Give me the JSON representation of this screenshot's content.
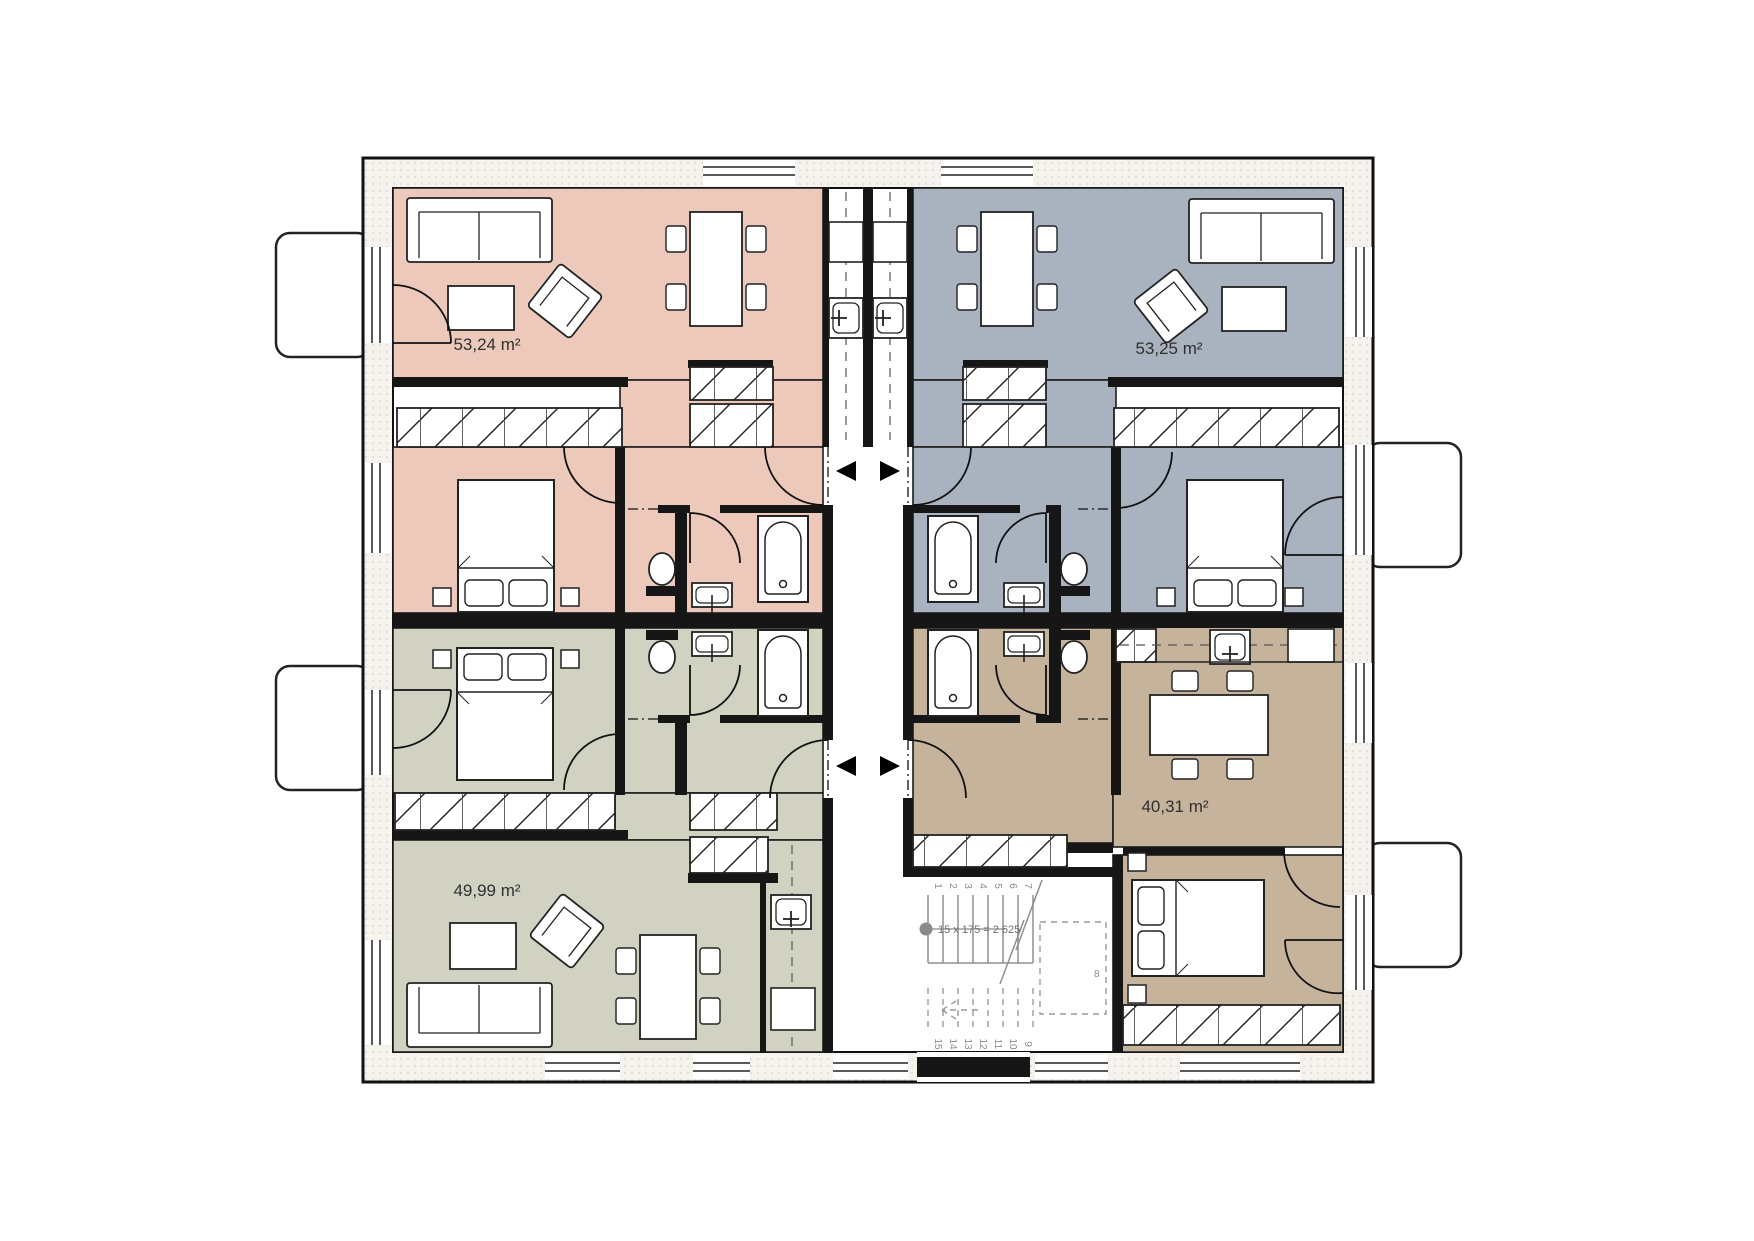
{
  "plan": {
    "apartments": [
      {
        "position": "top-left",
        "area_label": "53,24 m²"
      },
      {
        "position": "top-right",
        "area_label": "53,25 m²"
      },
      {
        "position": "bottom-left",
        "area_label": "49,99 m²"
      },
      {
        "position": "bottom-right",
        "area_label": "40,31 m²"
      }
    ],
    "staircase": {
      "annotation": "15 x 175 = 2 625",
      "steps_up": [
        "1",
        "2",
        "3",
        "4",
        "5",
        "6",
        "7"
      ],
      "mid_step": "8",
      "steps_down": [
        "9",
        "10",
        "11",
        "12",
        "13",
        "14",
        "15"
      ]
    }
  },
  "colors": {
    "pink": "#ecc9ba",
    "blue": "#a9b3c0",
    "green": "#d2d2c3",
    "tan": "#c6b39c",
    "wall": "#161616",
    "stair": "#8f8f8f",
    "label": "#2f2f2f",
    "ext": "#f6f3ef"
  }
}
